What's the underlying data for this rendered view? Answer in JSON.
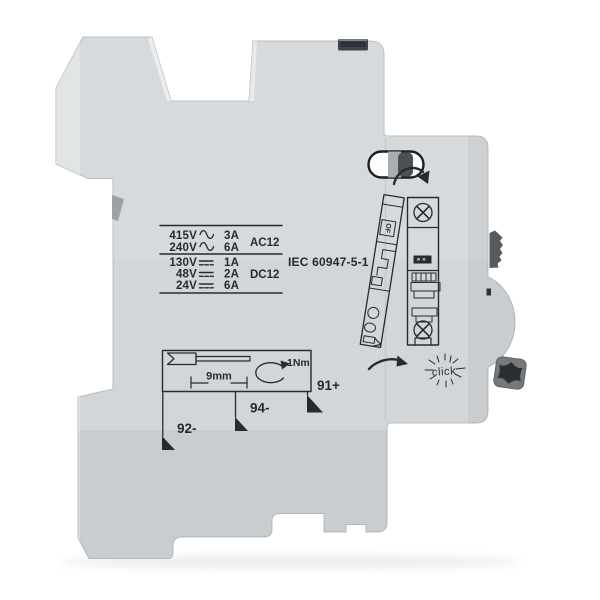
{
  "image": {
    "description": "Side view product photo of a light-gray DIN-rail auxiliary contact module for a miniature circuit breaker"
  },
  "ratings": {
    "ac": {
      "rows": [
        {
          "v": "415V",
          "a": "3A"
        },
        {
          "v": "240V",
          "a": "6A"
        }
      ],
      "class": "AC12"
    },
    "dc": {
      "rows": [
        {
          "v": "130V",
          "a": "1A"
        },
        {
          "v": "48V",
          "a": "2A"
        },
        {
          "v": "24V",
          "a": "6A"
        }
      ],
      "class": "DC12"
    },
    "standard": "IEC 60947-5-1"
  },
  "wiring": {
    "strip_length": "9mm",
    "torque": "1Nm"
  },
  "terminals": {
    "t92": "92-",
    "t94": "94-",
    "t91": "91+"
  },
  "mount_diagram": {
    "module_label": "OF",
    "click": "click"
  },
  "icons": [
    "ac-symbol-icon",
    "dc-symbol-icon",
    "wire-strip-icon",
    "torque-arrow-icon",
    "terminal-marker-icon",
    "screw-icon",
    "attach-arrow-icon",
    "click-rays-icon"
  ],
  "colors": {
    "background": "#ffffff",
    "body": "#d2d6d8",
    "body_edge": "#b7bcbf",
    "ink": "#262b30",
    "lever": "#565b5f",
    "slot": "#3f4449",
    "slot_dark": "#2d3135",
    "pin": "#75797c",
    "pin_socket": "#2b2f33",
    "window_outline": "#1b1f23",
    "window_slider": "#4b5054",
    "window_band": "#a9aeb1"
  }
}
